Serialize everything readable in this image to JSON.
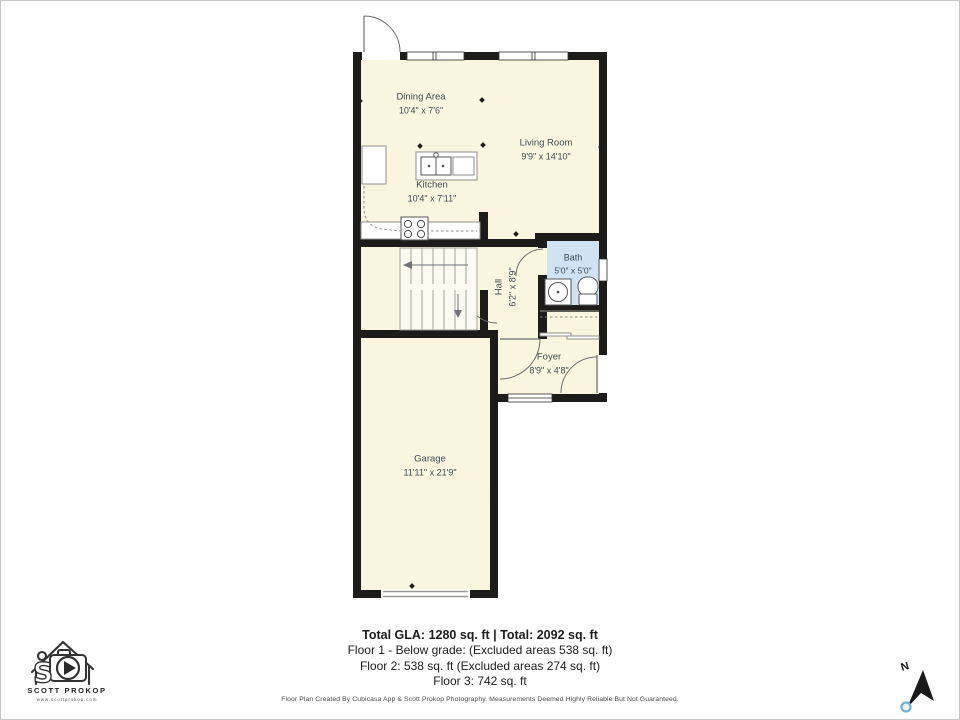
{
  "rooms": {
    "dining": {
      "name": "Dining Area",
      "dims": "10'4\" x 7'6\""
    },
    "living": {
      "name": "Living Room",
      "dims": "9'9\" x 14'10\""
    },
    "kitchen": {
      "name": "Kitchen",
      "dims": "10'4\" x 7'11\""
    },
    "hall": {
      "name": "Hall",
      "dims": "6'2\" x 8'9\""
    },
    "bath": {
      "name": "Bath",
      "dims": "5'0\" x 5'0\""
    },
    "foyer": {
      "name": "Foyer",
      "dims": "8'9\" x 4'8\""
    },
    "garage": {
      "name": "Garage",
      "dims": "11'11\" x 21'9\""
    }
  },
  "summary": {
    "total": "Total GLA: 1280 sq. ft | Total: 2092 sq. ft",
    "floor1": "Floor 1 - Below grade: (Excluded areas 538 sq. ft)",
    "floor2": "Floor 2: 538 sq. ft (Excluded areas 274 sq. ft)",
    "floor3": "Floor 3: 742 sq. ft"
  },
  "footer": "Floor Plan Created By Cubicasa App & Scott Prokop Photography. Measurements Deemed Highly Reliable But Not Guaranteed.",
  "logo": {
    "monogram": "S",
    "name": "SCOTT PROKOP",
    "url": "www.scottprokop.com"
  },
  "compass": {
    "label": "N"
  },
  "colors": {
    "wall": "#1d1c1a",
    "floor": "#faf5df",
    "bathfloor": "#cfe3f2",
    "compass_blue": "#72b0d4"
  }
}
